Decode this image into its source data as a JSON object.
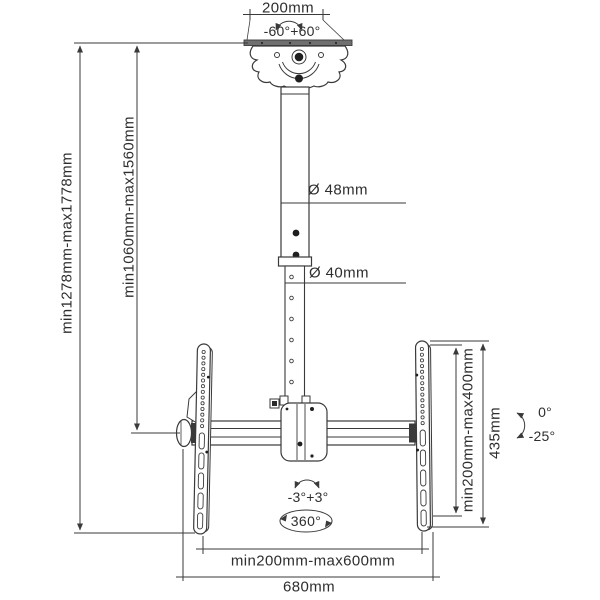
{
  "colors": {
    "background": "#ffffff",
    "line": "#3a3a3a",
    "text": "#2e2e2e"
  },
  "labels": {
    "top_width": "200mm",
    "swivel_range": "-60°+60°",
    "total_drop": "min1278mm-max1778mm",
    "pole_drop": "min1060mm-max1560mm",
    "upper_pole_diameter": "Ø 48mm",
    "lower_pole_diameter": "Ø 40mm",
    "vesa_vertical": "min200mm-max400mm",
    "bracket_height": "435mm",
    "tilt_up": "0°",
    "tilt_down": "-25°",
    "level_adjust": "-3°+3°",
    "rotation": "360°",
    "vesa_horizontal": "min200mm-max600mm",
    "crossbar_width": "680mm"
  }
}
